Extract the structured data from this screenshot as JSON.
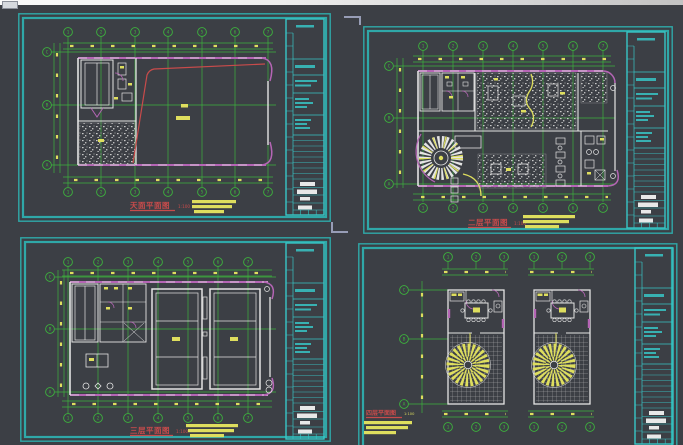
{
  "page": {
    "description": "CAD drawing view with four architectural floor-plan sheets"
  },
  "colors": {
    "bg": "#3c3f45",
    "cyan": "#2fa8a8",
    "cyan-bright": "#38c6c6",
    "green": "#3db23d",
    "yellow": "#dede5e",
    "magenta": "#b565b5",
    "white-line": "#e4e4e4",
    "red": "#c84b4b",
    "mark": "#979db6"
  },
  "sheets": [
    {
      "name": "roof-plan",
      "title": "天面平面图",
      "scale": "1:100",
      "axes": {
        "top": [
          "1",
          "2",
          "3",
          "4",
          "5",
          "6",
          "7"
        ],
        "bottom": [
          "1",
          "2",
          "3",
          "4",
          "5",
          "6",
          "7"
        ],
        "left": [
          "C",
          "B",
          "A"
        ]
      }
    },
    {
      "name": "second-floor-plan",
      "title": "二层平面图",
      "scale": "1:100",
      "axes": {
        "top": [
          "1",
          "2",
          "3",
          "4",
          "5",
          "6",
          "7"
        ],
        "bottom": [
          "1",
          "2",
          "3",
          "4",
          "5",
          "6",
          "7"
        ],
        "left": [
          "C",
          "B",
          "A"
        ]
      }
    },
    {
      "name": "third-floor-plan",
      "title": "三层平面图",
      "scale": "1:100",
      "axes": {
        "top": [
          "1",
          "2",
          "3",
          "4",
          "5",
          "6",
          "7"
        ],
        "bottom": [
          "1",
          "2",
          "3",
          "4",
          "5",
          "6",
          "7"
        ],
        "left": [
          "C",
          "B",
          "A"
        ]
      }
    },
    {
      "name": "fourth-floor-plan",
      "title": "四层平面图",
      "scale": "1:100",
      "axes": {
        "left": [
          "C",
          "B",
          "A"
        ],
        "unit1_top": [
          "1",
          "2",
          "3"
        ],
        "unit1_bottom": [
          "1",
          "2",
          "3"
        ],
        "unit2_top": [
          "1",
          "2",
          "3"
        ],
        "unit2_bottom": [
          "1",
          "2",
          "3"
        ]
      }
    }
  ]
}
